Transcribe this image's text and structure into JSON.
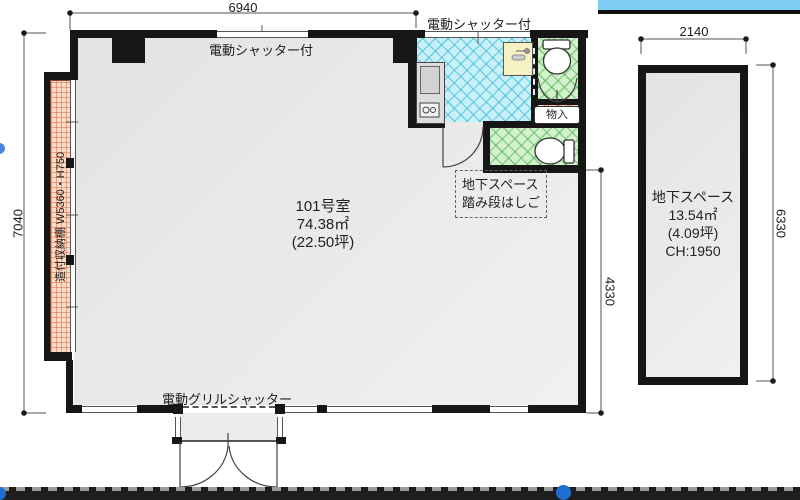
{
  "plan": {
    "dimensions": {
      "top_width": "6940",
      "left_height": "7040",
      "right_height": "4330",
      "basement_width": "2140",
      "basement_height": "6330"
    },
    "labels": {
      "shutter_main": "電動シャッター付",
      "shutter_wet": "電動シャッター付",
      "grill_shutter": "電動グリルシャッター",
      "shelf": "造付収納棚 W5360・H750",
      "closet": "物入"
    },
    "main_room": {
      "name": "101号室",
      "area_sqm": "74.38㎡",
      "area_tsubo": "(22.50坪)"
    },
    "basement_note": {
      "line1": "地下スペース",
      "line2": "踏み段はしご"
    },
    "basement_room": {
      "name": "地下スペース",
      "area_sqm": "13.54㎡",
      "area_tsubo": "(4.09坪)",
      "ceiling": "CH:1950"
    },
    "colors": {
      "wall": "#161616",
      "room_fill": "#e9e9e9",
      "wet_cyan": "#c9f0f7",
      "toilet_green": "#d3f1ca",
      "shelf_salmon": "#fbdcc8",
      "sink_yellow": "#f6f1c2",
      "top_bar_blue": "#7fcdf2",
      "bottom_bar": "#1e1e1e",
      "handle_blue": "#1f6fd0"
    }
  }
}
